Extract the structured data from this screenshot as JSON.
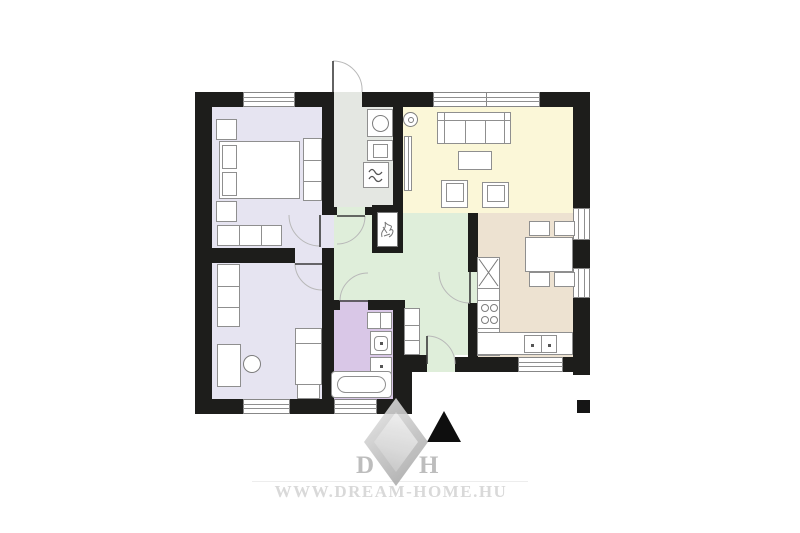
{
  "watermark": {
    "website": "WWW.DREAM-HOME.HU",
    "logo_left_letter": "D",
    "logo_right_letter": "H"
  },
  "colors": {
    "wall": "#1d1d1b",
    "bedroom_floor": "#e6e4f1",
    "bathroom_floor": "#d9c7e7",
    "utility_floor": "#e4e7e2",
    "hall_floor": "#dfeeda",
    "living_floor": "#fbf7d8",
    "kitchen_floor": "#ede2d1"
  },
  "rooms": [
    {
      "name": "bedroom-1",
      "color": "#e6e4f1"
    },
    {
      "name": "bedroom-2",
      "color": "#e6e4f1"
    },
    {
      "name": "utility-room",
      "color": "#e4e7e2"
    },
    {
      "name": "living-room",
      "color": "#fbf7d8"
    },
    {
      "name": "hallway",
      "color": "#dfeeda"
    },
    {
      "name": "entry-hall",
      "color": "#dfeeda"
    },
    {
      "name": "kitchen-dining",
      "color": "#ede2d1"
    },
    {
      "name": "bathroom",
      "color": "#d9c7e7"
    }
  ],
  "features": [
    "double-bed",
    "nightstand",
    "wardrobe",
    "dresser",
    "desk",
    "desk-chair",
    "single-bed",
    "washing-machine",
    "appliance",
    "boiler",
    "fireplace",
    "sofa",
    "coffee-table",
    "armchair",
    "tv-board",
    "wall-lamp",
    "dining-table",
    "dining-chair",
    "fridge",
    "stove-burners",
    "kitchen-sink",
    "shoe-cabinet",
    "bath-cabinet",
    "washbasin",
    "toilet",
    "bathtub",
    "north-arrow",
    "column-marker"
  ],
  "icons": {
    "north_arrow": "▲",
    "boiler": "wavy-lines",
    "fridge": "crossed-box"
  }
}
